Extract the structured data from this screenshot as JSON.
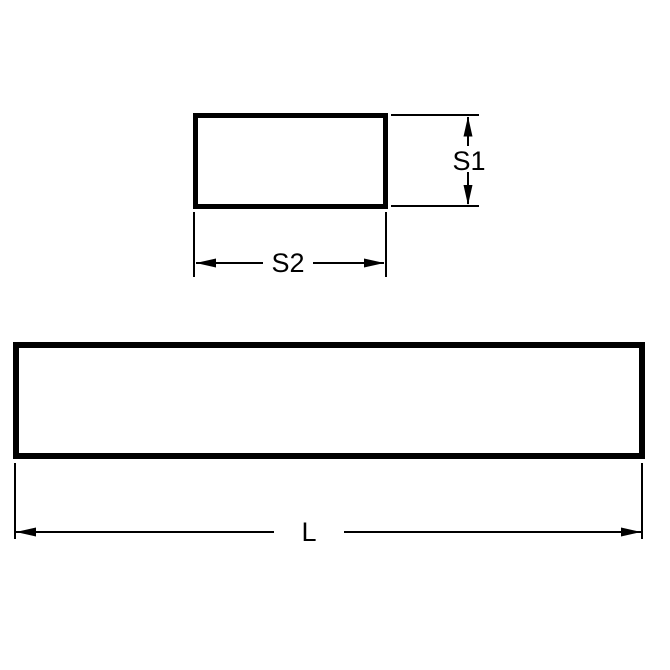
{
  "drawing": {
    "labels": {
      "section_height": "S1",
      "section_width": "S2",
      "length": "L"
    },
    "colors": {
      "line": "#000000",
      "text": "#000000",
      "background": "#ffffff"
    }
  }
}
